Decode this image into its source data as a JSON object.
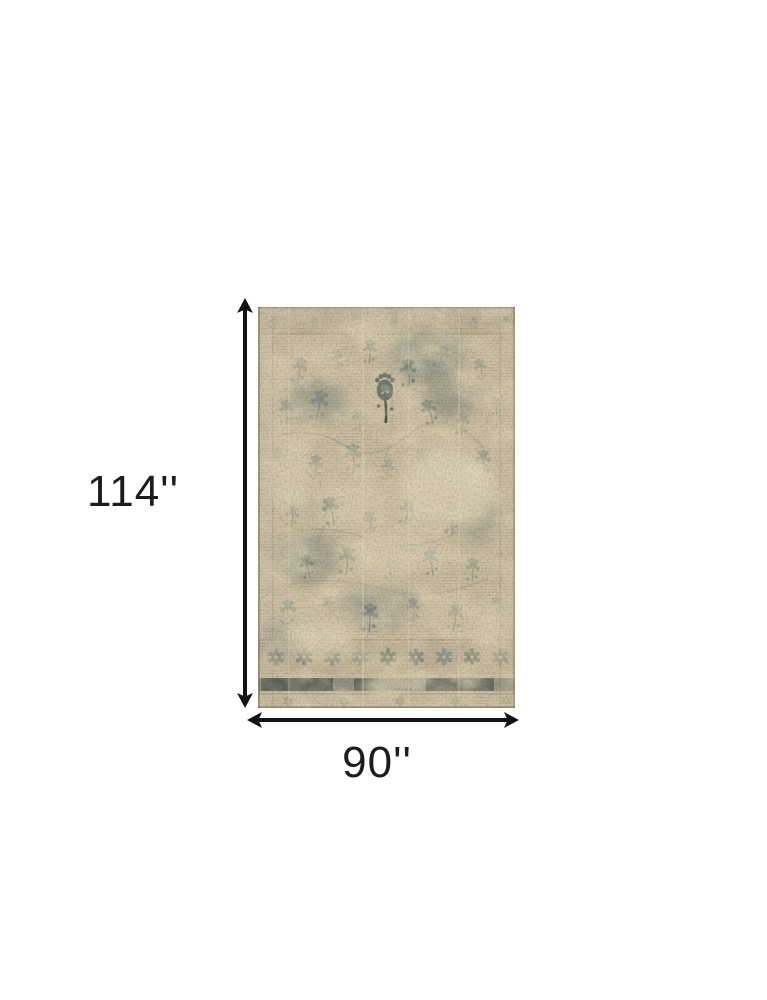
{
  "page": {
    "background_color": "#ffffff"
  },
  "diagram": {
    "description": "Area rug product dimension diagram",
    "height_label": "114''",
    "width_label": "90''",
    "height_inches": 114,
    "width_inches": 90,
    "arrow_color": "#131313",
    "label_color": "#1c1c1c",
    "rug": {
      "description": "Distressed beige and grey vintage oriental area rug",
      "colors": {
        "base": "#c8bba0",
        "worn": "#ddd3ba",
        "motif": "#75827c",
        "motif_dark": "#46524d",
        "border_line": "#8f8570"
      }
    }
  }
}
